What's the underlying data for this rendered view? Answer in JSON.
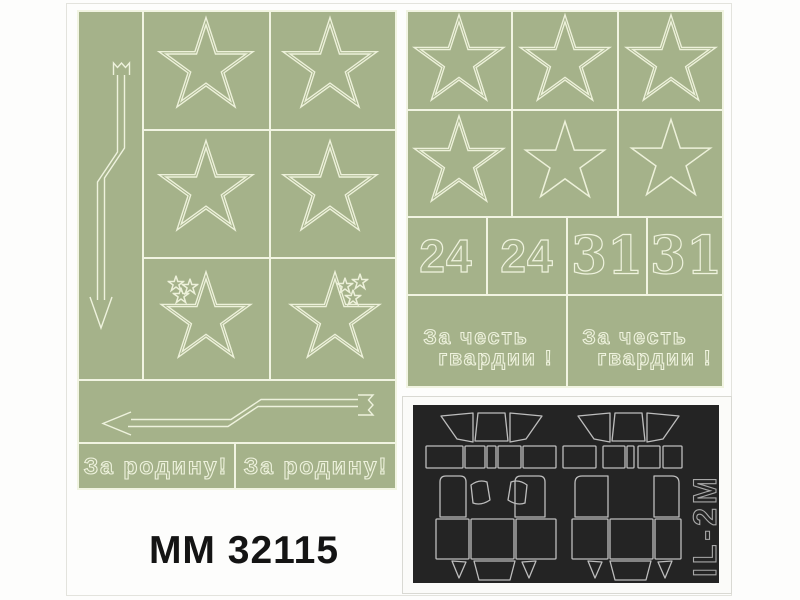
{
  "footer": {
    "code": "MM 32115"
  },
  "left_sheet": {
    "description": "green mask sheet with 6 star masks, 6 small star masks, 2 lightning-arrow masks",
    "slogans": [
      "За родину!",
      "За родину!"
    ],
    "star_mask_count": 6,
    "arrow_mask_count": 2
  },
  "right_sheet": {
    "description": "green mask sheet with 6 star masks, tactical numbers and slogans",
    "numbers": [
      "24",
      "24",
      "31",
      "31"
    ],
    "slogans": [
      {
        "line1": "За честь",
        "line2": "гвардии !"
      },
      {
        "line1": "За честь",
        "line2": "гвардии !"
      }
    ],
    "star_mask_count": 6
  },
  "black_sheet": {
    "label": "IL-2M",
    "description": "black vinyl canopy mask sheet, two canopy mask groups"
  },
  "colors": {
    "sheet_green": "#a5b28a",
    "cut_line": "#f1f4e2",
    "star_outline": "#edf1da",
    "black_sheet_bg": "#242424",
    "black_sheet_line": "#bdbdbd",
    "code_text": "#141414",
    "background": "#fdfdfc"
  }
}
